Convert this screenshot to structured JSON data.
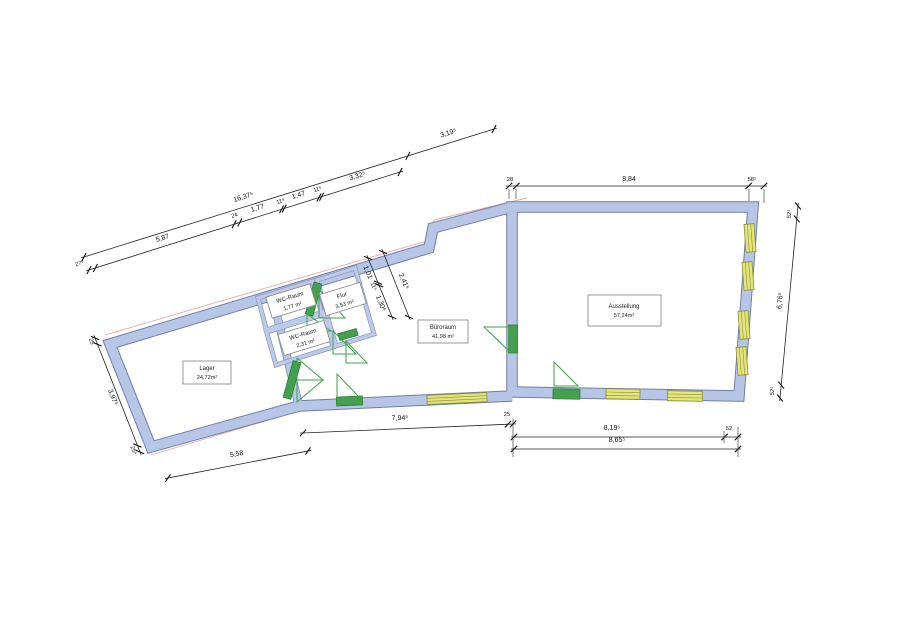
{
  "rooms": {
    "lager": {
      "name": "Lager",
      "area": "24,72m²"
    },
    "wc1": {
      "name": "WC-Raum",
      "area": "1,77 m²"
    },
    "flur": {
      "name": "Flur",
      "area": "3,53 m²"
    },
    "wc2": {
      "name": "WC-Raum",
      "area": "2,31 m²"
    },
    "buero": {
      "name": "Büroraum",
      "area": "41,98 m²"
    },
    "ausstellung": {
      "name": "Ausstellung",
      "area": "57,24m²"
    }
  },
  "dims": {
    "overall_top": "16,37⁵",
    "top_right_ext": "3,19⁵",
    "seg_27": "27⁵",
    "seg_587": "5,87",
    "seg_24": "24",
    "seg_177": "1,77",
    "seg_11a": "11⁵",
    "seg_147": "1,47",
    "seg_11b": "11⁵",
    "seg_332": "3,32⁵",
    "ausst_28": "28",
    "ausst_884": "8,84",
    "ausst_58": "58⁵",
    "right_52t": "52⁵",
    "right_676": "6,76⁵",
    "right_52b": "52⁵",
    "mid_101": "1,01",
    "mid_11": "11⁵",
    "mid_130": "1,30⁵",
    "mid_241": "2,41⁵",
    "left_25t": "25",
    "left_397": "3,97⁵",
    "left_25b": "25⁵",
    "bottom_558": "5,58",
    "bottom_794": "7,94⁵",
    "bottom_25": "25",
    "bottom_819": "8,19⁵",
    "bottom_52": "52",
    "bottom_865": "8,65⁵"
  },
  "colors": {
    "wall_fill": "#b7c5e7",
    "wall_edge": "#6f7fa3",
    "door_green": "#44a04f",
    "window_yellow": "#e5e678",
    "outline_red": "#e8a7a7",
    "dimension": "#111111"
  }
}
